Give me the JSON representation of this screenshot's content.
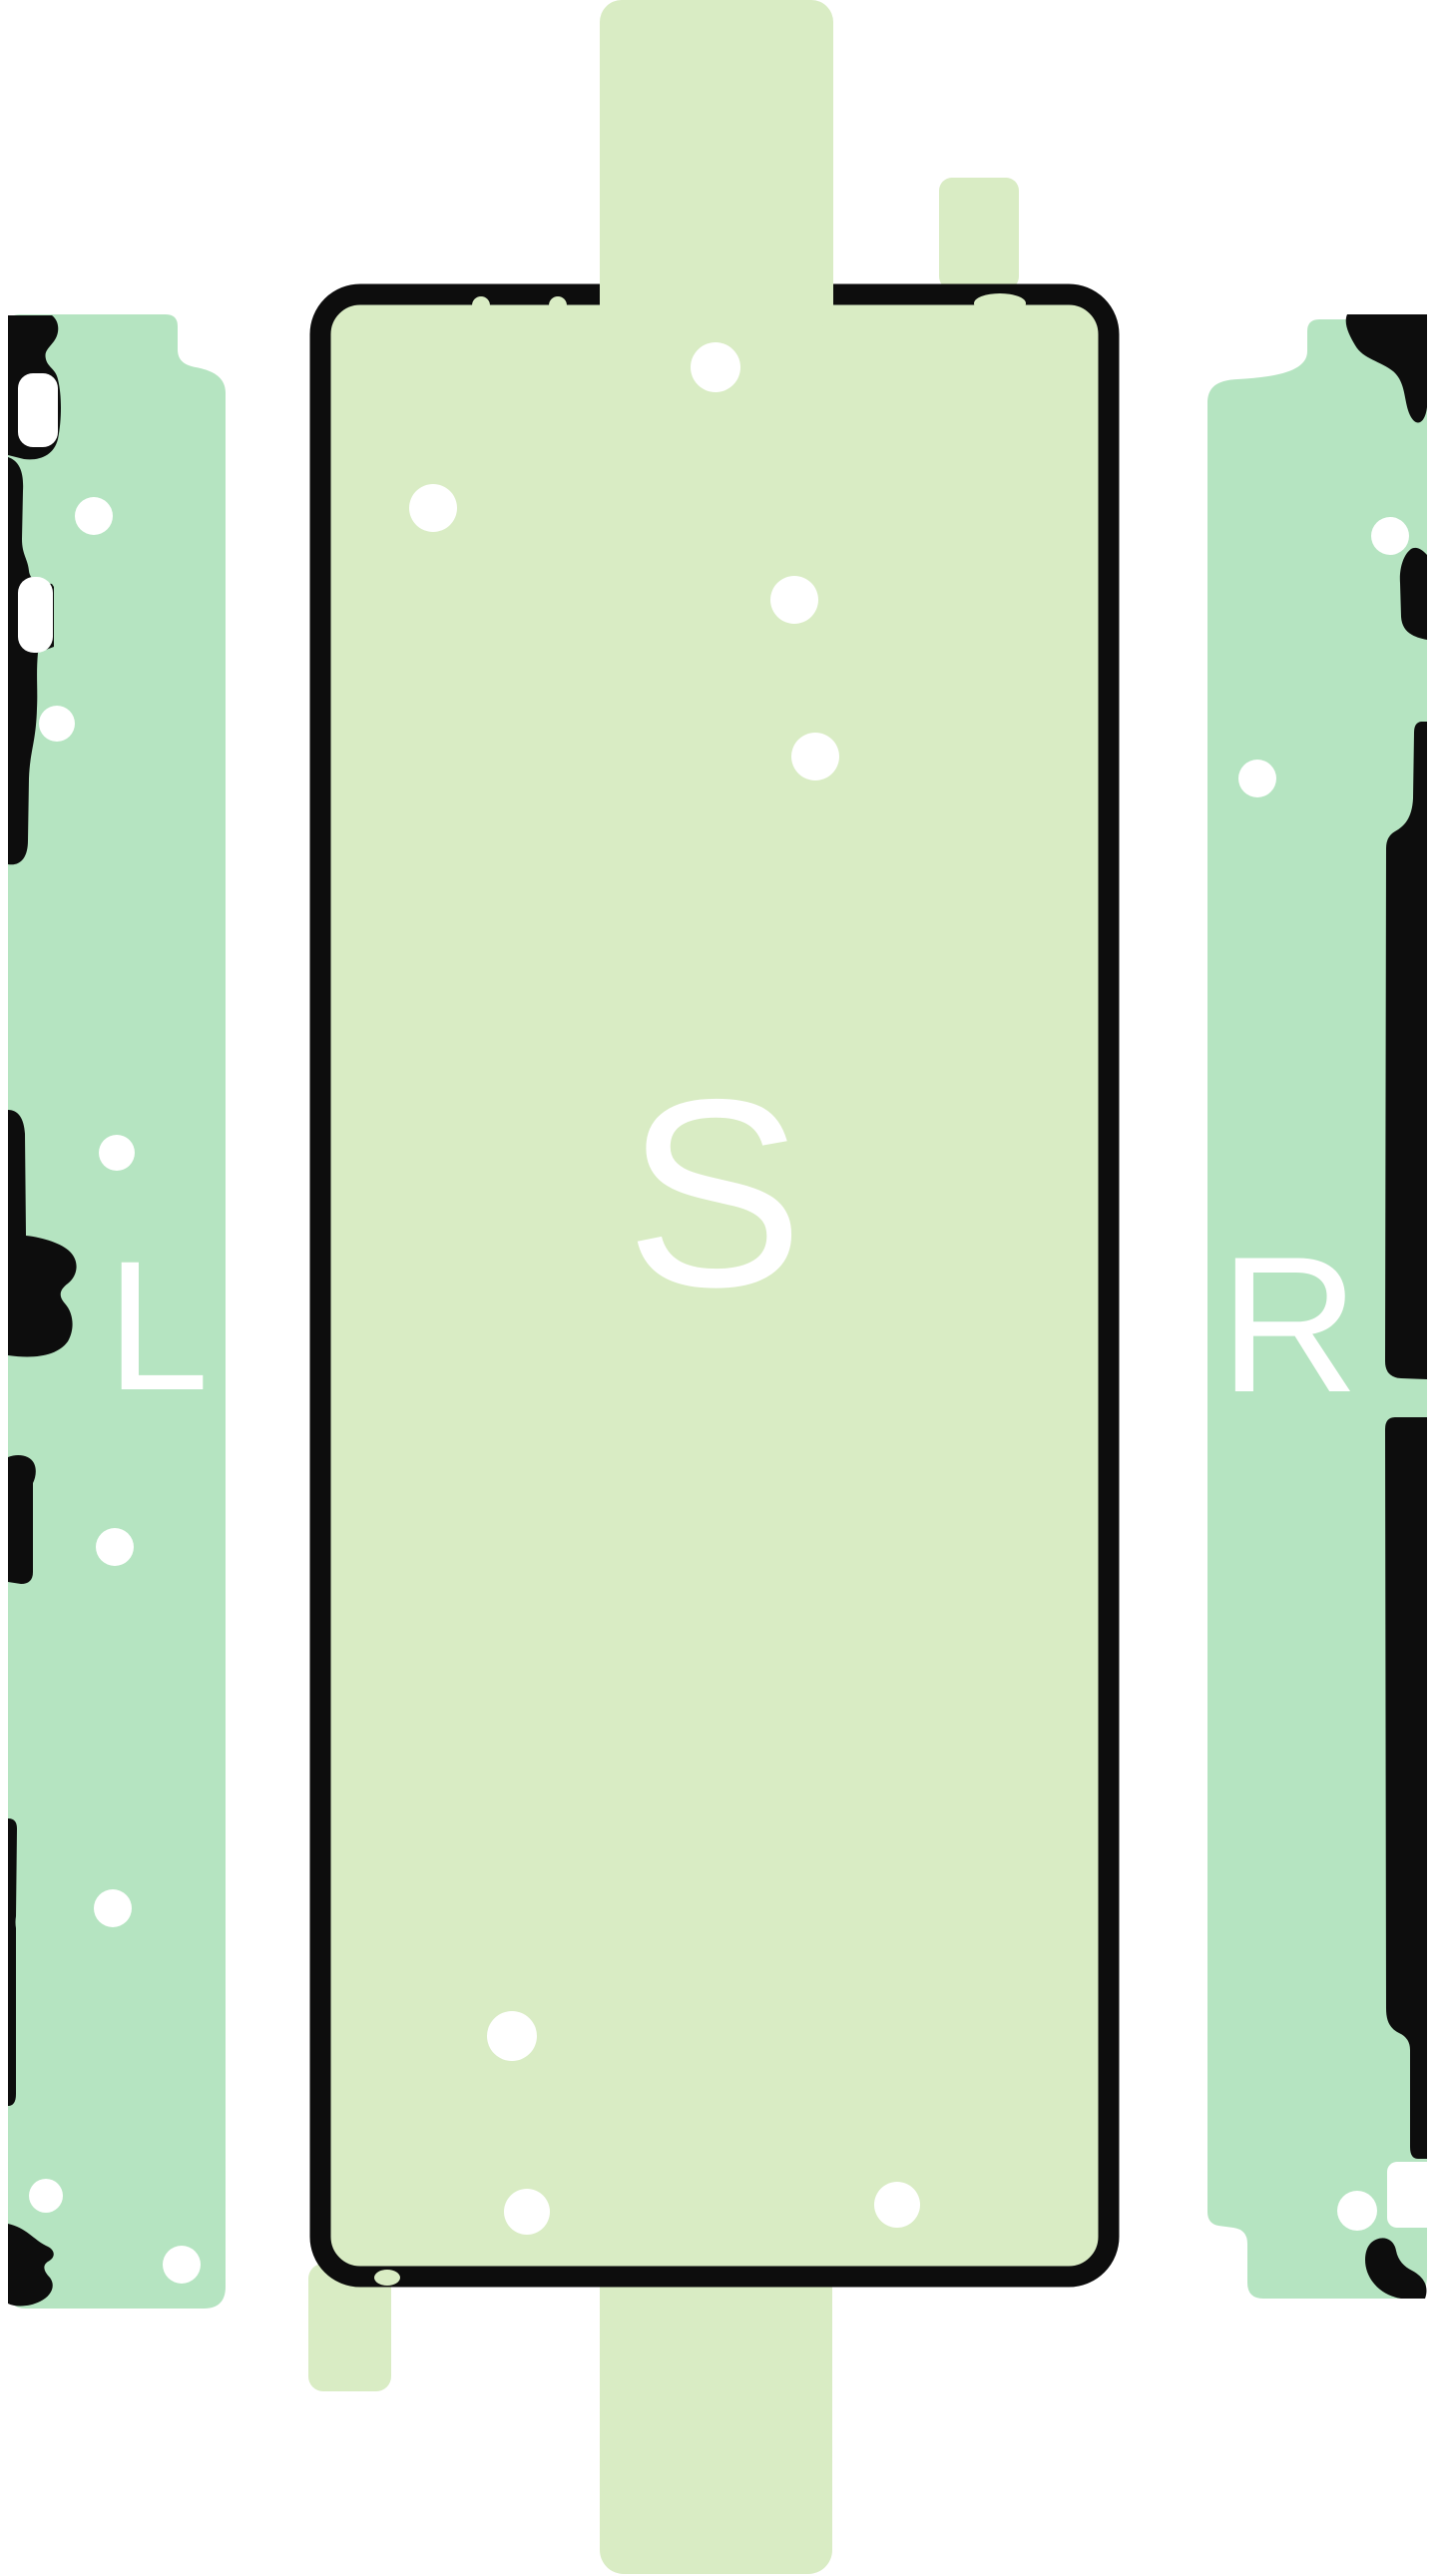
{
  "pieces": {
    "left": {
      "label": "L"
    },
    "screen": {
      "label": "S"
    },
    "right": {
      "label": "R"
    }
  },
  "colors": {
    "background": "#ffffff",
    "screen_fill": "#d9ecc4",
    "strip_fill": "#b5e4c1",
    "outline_black": "#0d0d0d",
    "cutout_white": "#ffffff",
    "label_white": "#ffffff"
  }
}
